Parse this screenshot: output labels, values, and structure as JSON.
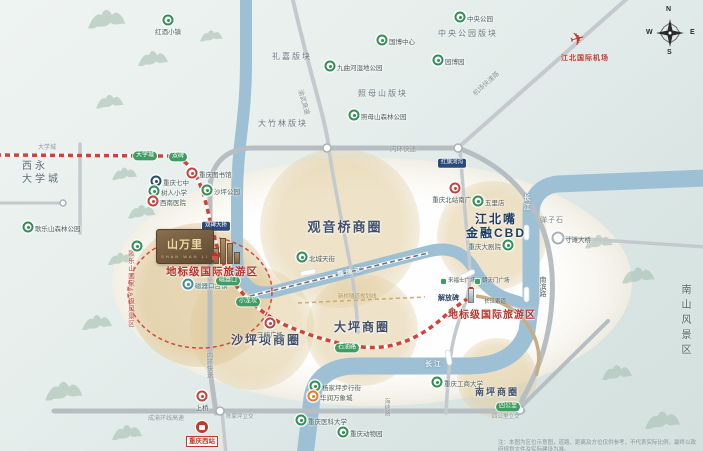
{
  "project": {
    "logo_title": "山万里",
    "logo_sub": "SHAN WAN LI",
    "slogan": "地标级国际旅游区"
  },
  "jiefangbei": {
    "slogan": "地标级国际旅游区"
  },
  "airport": {
    "label": "江北国际机场"
  },
  "station": {
    "label": "重庆西站"
  },
  "compass": {
    "n": "N",
    "e": "E",
    "s": "S",
    "w": "W"
  },
  "disclaimer": "注：本图为区位示意图，道路、距离及方位仅供参考，不代表实际比例，最终以政府规划文件及实际建设为准。",
  "circles": [
    {
      "x": 340,
      "y": 228,
      "r": 80,
      "l": [
        "观音桥商圈"
      ],
      "lx": 345,
      "ly": 228,
      "fs": 13
    },
    {
      "x": 492,
      "y": 236,
      "r": 55,
      "l": [
        "江北嘴",
        "金融CBD"
      ],
      "lx": 496,
      "ly": 227,
      "fs": 12,
      "navy": true
    },
    {
      "x": 252,
      "y": 328,
      "r": 62,
      "l": [
        "沙坪坝商圈"
      ],
      "lx": 266,
      "ly": 341,
      "fs": 12
    },
    {
      "x": 362,
      "y": 330,
      "r": 56,
      "l": [
        "大坪商圈"
      ],
      "lx": 362,
      "ly": 328,
      "fs": 12
    },
    {
      "x": 497,
      "y": 378,
      "r": 40,
      "l": [
        "南坪商圈"
      ],
      "lx": 497,
      "ly": 392,
      "fs": 9
    },
    {
      "x": 200,
      "y": 295,
      "r": 72,
      "l": [],
      "lx": 0,
      "ly": 0,
      "fs": 0,
      "strong": true
    }
  ],
  "zones": [
    {
      "t": "西永\n大学城",
      "x": 22,
      "y": 160,
      "fs": 10,
      "c": "#5d6e76",
      "ls": 3
    },
    {
      "t": "礼嘉版块",
      "x": 272,
      "y": 52,
      "fs": 8,
      "ls": 2
    },
    {
      "t": "大竹林版块",
      "x": 258,
      "y": 119,
      "fs": 8,
      "ls": 2
    },
    {
      "t": "照母山版块",
      "x": 358,
      "y": 89,
      "fs": 8,
      "ls": 2
    },
    {
      "t": "中央公园版块",
      "x": 438,
      "y": 29,
      "fs": 8,
      "ls": 2
    },
    {
      "t": "弹子石",
      "x": 540,
      "y": 216,
      "fs": 7,
      "c": "#7c8a90",
      "ls": 1
    },
    {
      "t": "南山风景区",
      "x": 678,
      "y": 284,
      "fs": 10,
      "c": "#55655d",
      "ls": 5,
      "v": true
    },
    {
      "t": "歌乐山国家4A级风景区",
      "x": 125,
      "y": 250,
      "fs": 6.5,
      "c": "#bf4a40",
      "ls": 1,
      "v": true
    },
    {
      "t": "大学城",
      "x": 38,
      "y": 145,
      "fs": 6,
      "c": "#8a9598"
    },
    {
      "t": "来福士广场",
      "x": 448,
      "y": 278,
      "fs": 5.5,
      "c": "#4a5a60"
    },
    {
      "t": "朝天门广场",
      "x": 482,
      "y": 278,
      "fs": 5.5,
      "c": "#4a5a60"
    },
    {
      "t": "长江索道",
      "x": 484,
      "y": 299,
      "fs": 5.5,
      "c": "#4a5a60"
    },
    {
      "t": "四公里立交",
      "x": 492,
      "y": 414,
      "fs": 5.5,
      "c": "#8a9598"
    },
    {
      "t": "陈家坪立交",
      "x": 226,
      "y": 414,
      "fs": 5.5,
      "c": "#8a9598"
    },
    {
      "t": "解放碑",
      "x": 438,
      "y": 294,
      "fs": 7,
      "c": "#2c4468",
      "b": true
    }
  ],
  "road_labels": [
    {
      "t": "内环快速",
      "x": 390,
      "y": 143,
      "fs": 6.5
    },
    {
      "t": "内环快速",
      "x": 203,
      "y": 352,
      "fs": 6.5,
      "v": true
    },
    {
      "t": "机场快速路",
      "x": 470,
      "y": 90,
      "fs": 6.5,
      "rot": -42
    },
    {
      "t": "渝武高速",
      "x": 306,
      "y": 88,
      "fs": 6.5,
      "rot": 74
    },
    {
      "t": "成渝环线高速",
      "x": 148,
      "y": 413,
      "fs": 6
    },
    {
      "t": "海峡路",
      "x": 382,
      "y": 398,
      "fs": 6,
      "v": true
    },
    {
      "t": "南滨路",
      "x": 537,
      "y": 276,
      "fs": 7,
      "v": true,
      "c": "#4f5d57"
    },
    {
      "t": "新桥隧道规划线",
      "x": 338,
      "y": 292,
      "fs": 5.5,
      "c": "#b09256"
    }
  ],
  "river_labels": [
    {
      "t": "嘉陵江",
      "x": 336,
      "y": 270,
      "rot": -12
    },
    {
      "t": "长江",
      "x": 425,
      "y": 359,
      "rot": 0
    },
    {
      "t": "长江",
      "x": 521,
      "y": 194,
      "v": true
    }
  ],
  "markers": [
    {
      "x": 168,
      "y": 20,
      "k": "g",
      "t": "红酒小镇",
      "p": "b"
    },
    {
      "x": 330,
      "y": 66,
      "k": "g",
      "t": "九曲河湿地公园",
      "p": "r"
    },
    {
      "x": 382,
      "y": 40,
      "k": "g",
      "t": "国博中心",
      "p": "r"
    },
    {
      "x": 460,
      "y": 17,
      "k": "g",
      "t": "中央公园",
      "p": "r"
    },
    {
      "x": 438,
      "y": 60,
      "k": "g",
      "t": "园博园",
      "p": "r"
    },
    {
      "x": 354,
      "y": 115,
      "k": "g",
      "t": "照母山森林公园",
      "p": "r"
    },
    {
      "x": 28,
      "y": 227,
      "k": "g",
      "t": "歌乐山森林公园",
      "p": "r"
    },
    {
      "x": 156,
      "y": 181,
      "k": "d",
      "t": "重庆七中",
      "p": "r"
    },
    {
      "x": 154,
      "y": 191,
      "k": "g",
      "t": "树人小学",
      "p": "r"
    },
    {
      "x": 153,
      "y": 201,
      "k": "r",
      "t": "西南医院",
      "p": "r"
    },
    {
      "x": 192,
      "y": 173,
      "k": "r",
      "t": "重庆图书馆",
      "p": "r"
    },
    {
      "x": 207,
      "y": 190,
      "k": "g",
      "t": "沙坪公园",
      "p": "r"
    },
    {
      "x": 137,
      "y": 246,
      "k": "g",
      "t": "",
      "p": "r"
    },
    {
      "x": 188,
      "y": 284,
      "k": "t",
      "t": "磁器口古镇",
      "p": "r"
    },
    {
      "x": 302,
      "y": 257,
      "k": "g",
      "t": "北城天街",
      "p": "r"
    },
    {
      "x": 455,
      "y": 188,
      "k": "r",
      "t": "重庆北站南广场",
      "p": "b"
    },
    {
      "x": 478,
      "y": 201,
      "k": "g",
      "t": "五里店",
      "p": "r"
    },
    {
      "x": 508,
      "y": 245,
      "k": "g",
      "t": "重庆大剧院",
      "p": "l"
    },
    {
      "x": 270,
      "y": 323,
      "k": "r",
      "t": "三峡广场",
      "p": "b"
    },
    {
      "x": 558,
      "y": 238,
      "k": "w",
      "t": "寸滩大桥",
      "p": "r"
    },
    {
      "x": 437,
      "y": 382,
      "k": "g",
      "t": "重庆工商大学",
      "p": "r"
    },
    {
      "x": 315,
      "y": 386,
      "k": "g",
      "t": "杨家坪步行街",
      "p": "r"
    },
    {
      "x": 313,
      "y": 396,
      "k": "o",
      "t": "华润万象城",
      "p": "r"
    },
    {
      "x": 202,
      "y": 396,
      "k": "r",
      "t": "上桥",
      "p": "b"
    },
    {
      "x": 301,
      "y": 420,
      "k": "g",
      "t": "重庆医科大学",
      "p": "r"
    },
    {
      "x": 343,
      "y": 432,
      "k": "g",
      "t": "重庆动物园",
      "p": "r"
    }
  ],
  "badges": [
    {
      "x": 145,
      "y": 156,
      "t": "大学城",
      "k": "g"
    },
    {
      "x": 178,
      "y": 157,
      "t": "双碑",
      "k": "g"
    },
    {
      "x": 228,
      "y": 281,
      "t": "磁器口",
      "k": "g"
    },
    {
      "x": 248,
      "y": 302,
      "t": "小龙坎",
      "k": "g"
    },
    {
      "x": 347,
      "y": 348,
      "t": "石油路",
      "k": "g"
    },
    {
      "x": 508,
      "y": 407,
      "t": "四公里",
      "k": "g"
    },
    {
      "x": 452,
      "y": 163,
      "t": "红旗河沟",
      "k": "n"
    },
    {
      "x": 216,
      "y": 226,
      "t": "双碑大桥",
      "k": "n"
    }
  ]
}
